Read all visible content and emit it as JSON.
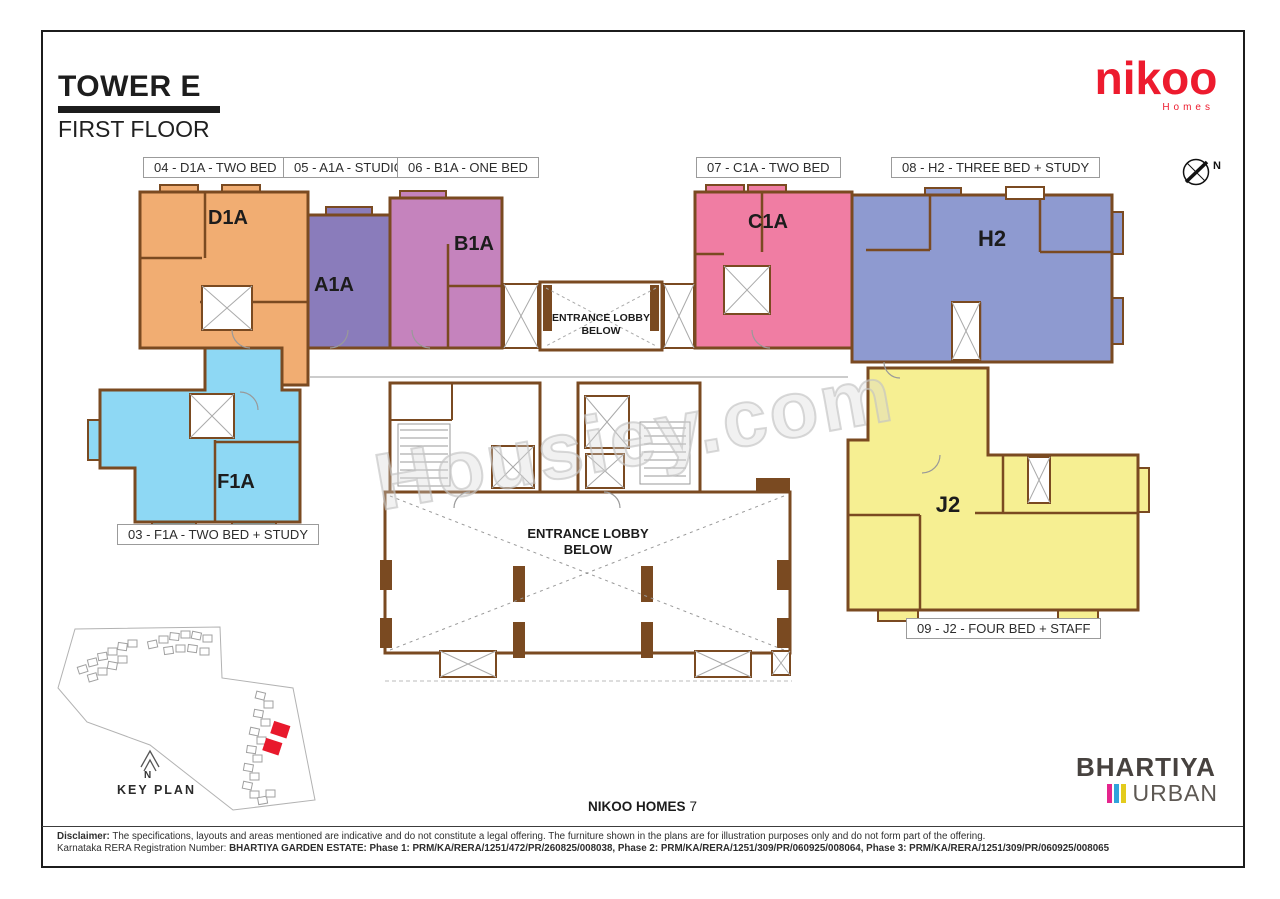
{
  "header": {
    "title": "TOWER E",
    "subtitle": "FIRST FLOOR"
  },
  "brand": {
    "name": "nikoo",
    "sub": "Homes",
    "color": "#ed1b2e"
  },
  "compass": {
    "label": "N"
  },
  "unit_tags": [
    {
      "label": "04 - D1A - TWO BED"
    },
    {
      "label": "05 - A1A - STUDIO"
    },
    {
      "label": "06 - B1A - ONE BED"
    },
    {
      "label": "07 - C1A - TWO BED"
    },
    {
      "label": "08 - H2 - THREE BED + STUDY"
    },
    {
      "label": "03 - F1A - TWO BED + STUDY"
    },
    {
      "label": "09 - J2 - FOUR BED + STAFF"
    }
  ],
  "units": [
    {
      "name": "D1A",
      "color": "#f1ad72"
    },
    {
      "name": "A1A",
      "color": "#8a7cbb"
    },
    {
      "name": "B1A",
      "color": "#c583bd"
    },
    {
      "name": "C1A",
      "color": "#f07da3"
    },
    {
      "name": "H2",
      "color": "#8e9ad0"
    },
    {
      "name": "F1A",
      "color": "#8ed8f4"
    },
    {
      "name": "J2",
      "color": "#f6ef92"
    }
  ],
  "plan": {
    "wall_color": "#7a4a21",
    "lobby_upper_line1": "ENTRANCE LOBBY",
    "lobby_upper_line2": "BELOW",
    "lobby_lower_line1": "ENTRANCE LOBBY",
    "lobby_lower_line2": "BELOW"
  },
  "watermark": "Housiey.com",
  "keyplan": {
    "title": "KEY PLAN",
    "north": "N",
    "highlight_color": "#e8192c"
  },
  "footer": {
    "project": "NIKOO HOMES",
    "number": "7"
  },
  "developer": {
    "name": "BHARTIYA",
    "division": "URBAN",
    "bars": [
      "#e5258d",
      "#31a3dc",
      "#e3cb1d"
    ]
  },
  "legal": {
    "disclaimer_label": "Disclaimer:",
    "disclaimer_text": " The specifications, layouts and areas mentioned are indicative and do not constitute a legal offering. The furniture shown in the plans are for illustration purposes only and do not form part of the offering.",
    "rera_label": "Karnataka RERA Registration Number: ",
    "rera_text": "BHARTIYA GARDEN ESTATE: Phase 1: PRM/KA/RERA/1251/472/PR/260825/008038, Phase 2: PRM/KA/RERA/1251/309/PR/060925/008064, Phase 3: PRM/KA/RERA/1251/309/PR/060925/008065"
  }
}
